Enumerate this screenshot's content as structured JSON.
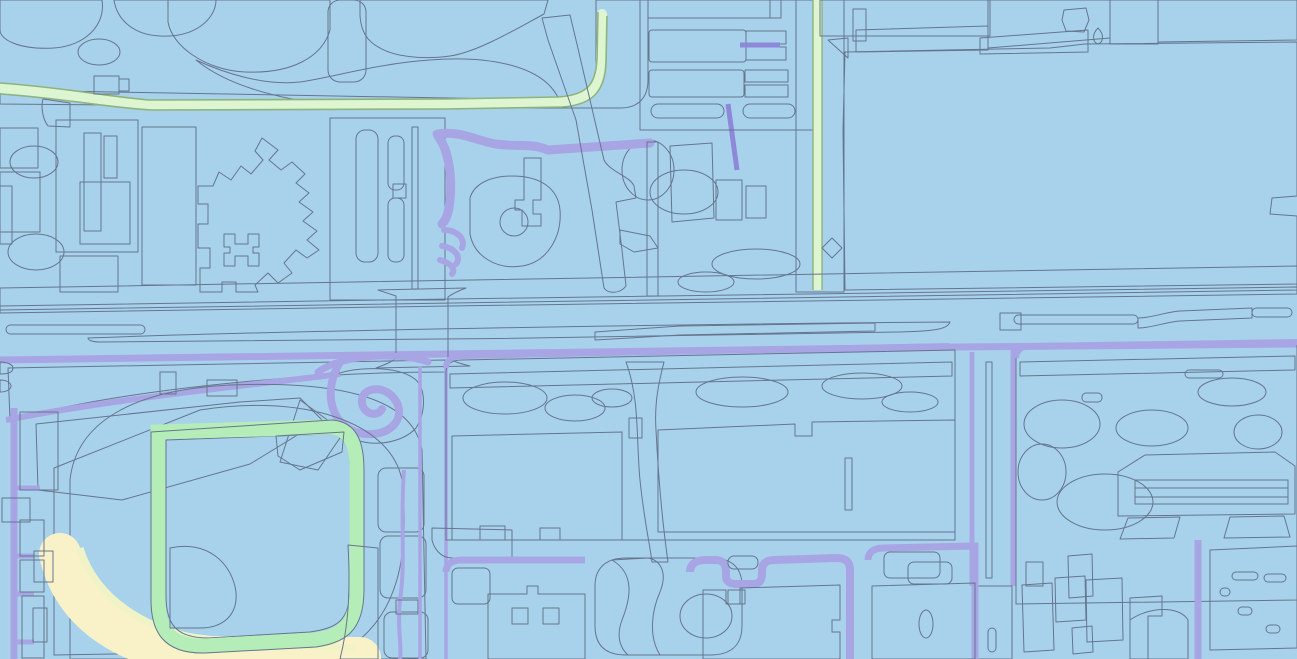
{
  "meta": {
    "type": "vector-parcel-map",
    "description": "Pastel-colored city map tile with a baseball stadium in the southwest, a wide pink arterial highway crossing the middle, rows of pink parking lots in the north, a large pink industrial block in the northeast, green warehouse footprints in the center-south, and light-blue terrain with local cyan and purple streets.",
    "width": 1297,
    "height": 659,
    "visible_text": "none"
  },
  "palette": {
    "outline": "#66758e",
    "blueMid": "#a8d2ec",
    "blueLight": "#c5e4f5",
    "blueLighter": "#d4ecf8",
    "blueDeep": "#9bc6e4",
    "cyanRoad": "#d6f1f5",
    "cyanPale": "#e2f7f8",
    "green": "#b5edb8",
    "greenPale": "#ddf5d0",
    "greenEdge": "#8fb37c",
    "infield": "#bdf2b4",
    "pinkBlock": "#fbb0dc",
    "pinkBright": "#f99cd9",
    "pinkRow": "#f9a4de",
    "pinkRoad": "#f8cbef",
    "lavender": "#dbcdf4",
    "lavenderLight": "#e6dcf8",
    "lavenderCell": "#cfc2ee",
    "purpleRoad": "#a8a5e5",
    "purpleDeep": "#8d88d8",
    "grayLine": "#b8b3d6",
    "cream": "#f9f2c9",
    "creamBldg": "#f6e9bf",
    "yellowPale": "#eff3c6",
    "peach": "#f9d9a9",
    "orange": "#f3b287",
    "tan": "#eec18f",
    "paleSliver": "#dde9f2"
  },
  "legend": [
    {
      "id": "terrain",
      "label": "base terrain",
      "color_key": "blueMid"
    },
    {
      "id": "terrain-patch",
      "label": "terrain patches",
      "color_key": "blueLight"
    },
    {
      "id": "local-road",
      "label": "local streets",
      "color_key": "cyanRoad"
    },
    {
      "id": "collector-road",
      "label": "collector streets",
      "color_key": "purpleRoad"
    },
    {
      "id": "arterial-road",
      "label": "arterial highway",
      "color_key": "pinkRoad"
    },
    {
      "id": "ramp",
      "label": "diagonal ramp road",
      "color_key": "orange"
    },
    {
      "id": "median",
      "label": "median islands",
      "color_key": "peach"
    },
    {
      "id": "building-cream",
      "label": "cream buildings",
      "color_key": "creamBldg"
    },
    {
      "id": "building-pink",
      "label": "pink buildings / lots",
      "color_key": "pinkRow"
    },
    {
      "id": "building-green",
      "label": "green buildings / lots",
      "color_key": "green"
    },
    {
      "id": "big-parcel-pink",
      "label": "large pink parcel",
      "color_key": "pinkBlock"
    },
    {
      "id": "stadium-field",
      "label": "stadium field",
      "color_key": "pinkBlock"
    },
    {
      "id": "stadium-ring",
      "label": "stadium seating ring",
      "color_key": "green"
    },
    {
      "id": "stadium-infield",
      "label": "stadium infield",
      "color_key": "infield"
    },
    {
      "id": "parcel-lavender",
      "label": "lavender parcels",
      "color_key": "lavender"
    }
  ],
  "features": [
    {
      "name": "baseball-stadium",
      "bbox": [
        60,
        385,
        430,
        659
      ]
    },
    {
      "name": "stadium-infield",
      "bbox": [
        162,
        540,
        240,
        630
      ]
    },
    {
      "name": "castle-shaped-building",
      "bbox": [
        196,
        138,
        322,
        292
      ]
    },
    {
      "name": "north-cream-blob-west",
      "bbox": [
        165,
        0,
        332,
        72
      ]
    },
    {
      "name": "north-cream-blob-east",
      "bbox": [
        360,
        0,
        548,
        60
      ]
    },
    {
      "name": "parking-rows-block",
      "bbox": [
        640,
        0,
        815,
        128
      ]
    },
    {
      "name": "large-pink-industrial-parcel",
      "bbox": [
        843,
        45,
        1297,
        290
      ]
    },
    {
      "name": "diagonal-orange-ramp",
      "bbox": [
        542,
        15,
        636,
        292
      ]
    },
    {
      "name": "pink-arterial-highway",
      "bbox": [
        0,
        288,
        1297,
        362
      ]
    },
    {
      "name": "peach-intersection",
      "bbox": [
        396,
        295,
        448,
        362
      ]
    },
    {
      "name": "pink-vertical-avenue-west",
      "bbox": [
        420,
        362,
        446,
        659
      ]
    },
    {
      "name": "pink-vertical-avenue-east",
      "bbox": [
        968,
        348,
        1016,
        585
      ]
    },
    {
      "name": "green-warehouse-west",
      "bbox": [
        452,
        433,
        622,
        540
      ]
    },
    {
      "name": "green-warehouse-east",
      "bbox": [
        658,
        422,
        958,
        532
      ]
    },
    {
      "name": "green-lot-south",
      "bbox": [
        870,
        583,
        975,
        659
      ]
    },
    {
      "name": "green-lot-southeast",
      "bbox": [
        1205,
        548,
        1297,
        648
      ]
    },
    {
      "name": "striped-awning-building",
      "bbox": [
        1118,
        455,
        1295,
        515
      ]
    },
    {
      "name": "pond-parcel",
      "bbox": [
        595,
        558,
        742,
        655
      ]
    },
    {
      "name": "hotel-lollipop-building",
      "bbox": [
        502,
        158,
        541,
        235
      ]
    },
    {
      "name": "loop-interchange",
      "bbox": [
        330,
        352,
        425,
        448
      ]
    },
    {
      "name": "green-edged-road",
      "bbox": [
        0,
        82,
        650,
        120
      ]
    },
    {
      "name": "small-yellow-diamond",
      "bbox": [
        822,
        238,
        842,
        258
      ]
    }
  ]
}
